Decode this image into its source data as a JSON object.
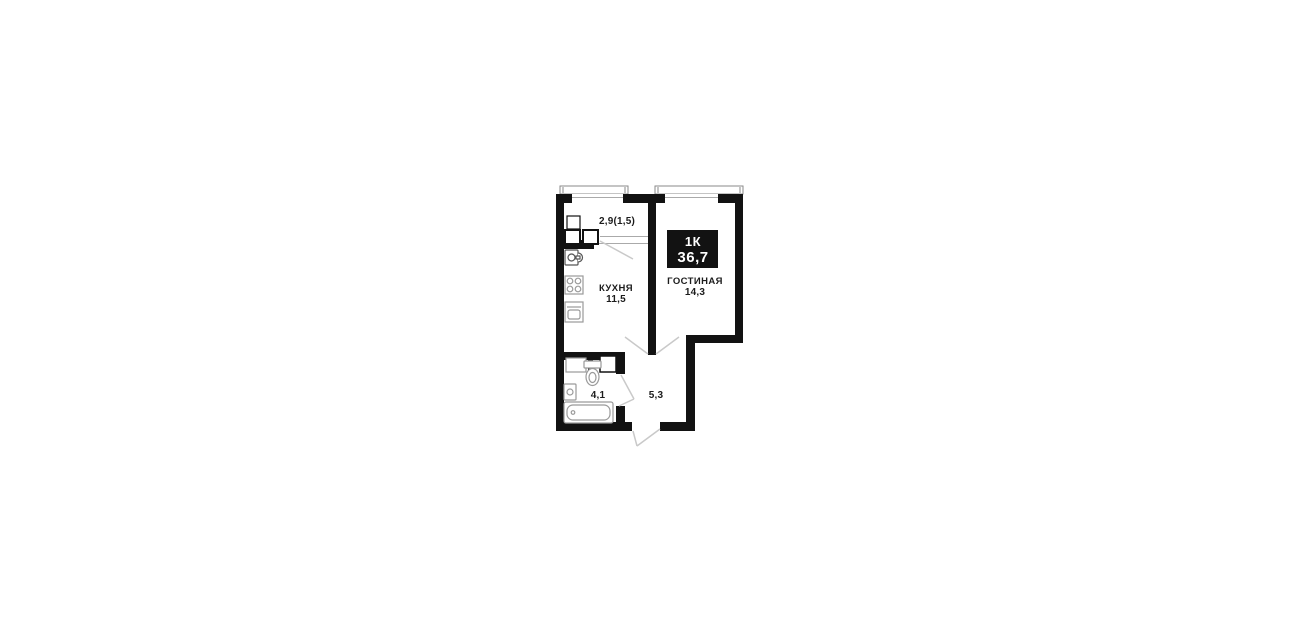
{
  "page": {
    "background": "#ffffff"
  },
  "plan": {
    "badge": {
      "type": "1К",
      "total_area": "36,7"
    },
    "rooms": {
      "balcony": {
        "area": "2,9(1,5)"
      },
      "kitchen": {
        "name": "КУХНЯ",
        "area": "11,5"
      },
      "living_room": {
        "name": "ГОСТИНАЯ",
        "area": "14,3"
      },
      "bathroom": {
        "area": "4,1"
      },
      "hallway": {
        "area": "5,3"
      }
    },
    "colors": {
      "wall": "#121212",
      "badge_bg": "#121212",
      "badge_text": "#ffffff",
      "label_text": "#1c1c1c",
      "fixture_outline": "#9a9a9a",
      "door_swing": "#c9c9c9"
    },
    "fixtures": [
      "balcony-cabinet",
      "kitchen-sink",
      "stove",
      "refrigerator",
      "toilet",
      "wash-basin",
      "bathtub"
    ]
  }
}
